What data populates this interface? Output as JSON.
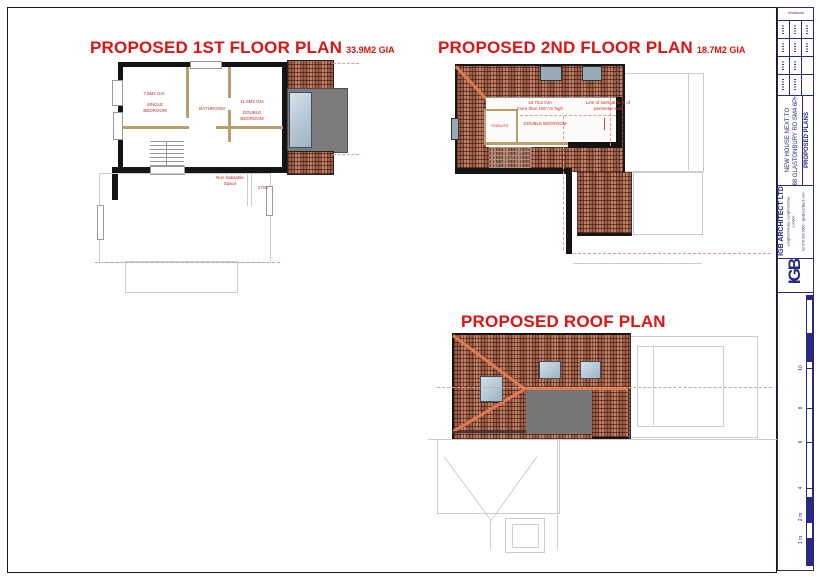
{
  "plans": {
    "first": {
      "title": "PROPOSED 1ST FLOOR PLAN",
      "gia": "33.9M2 GIA",
      "single_bedroom_area": "7.5M2 GIA",
      "single_bedroom": "SINGLE BEDROOM",
      "bathroom": "BATHROOM",
      "double_bedroom_area": "11.5M2 GIA",
      "double_bedroom": "DOUBLE BEDROOM",
      "non_habitable": "Non habitable Space",
      "level_note": "2700"
    },
    "second": {
      "title": "PROPOSED 2ND FLOOR PLAN",
      "gia": "18.7M2 GIA",
      "gia_note_line1": "18.7m2 GIA",
      "gia_note_line2": "more than 150 cm high",
      "perimeter_note": "Line of internal face of perimeter wall",
      "ensuite": "ENSUITE",
      "double_bedroom": "DOUBLE BEDROOM"
    },
    "roof": {
      "title": "PROPOSED ROOF PLAN"
    }
  },
  "titleblock": {
    "revisions_header": "revisions",
    "project_line1": "NEW HOUSE NEXT TO",
    "project_line2": "88 GLASTONBURY RD SM4 6PH",
    "drawing": "PROPOSED PLANS",
    "firm": "IGB ARCHITECT LTD",
    "address1": "Longford House, Longford Drive",
    "address2": "London",
    "contact": "tel 078 000 0000 - igb@architect.com",
    "logo": "IGB"
  },
  "scalebar": {
    "labels": [
      "10",
      "8",
      "6",
      "4",
      "2 m",
      "1 m"
    ]
  },
  "colors": {
    "title_red": "#e01212",
    "annotation_red": "#c03030",
    "tile_base": "#b5664b",
    "ridge_orange": "#e07a4f",
    "wall_black": "#141414",
    "partition_tan": "#b99f6e",
    "flat_roof_gray": "#7c7c7c",
    "skylight_blue": "#aec3d2",
    "titleblock_navy": "#2a2a85",
    "outline_gray": "#cdcdcd"
  }
}
